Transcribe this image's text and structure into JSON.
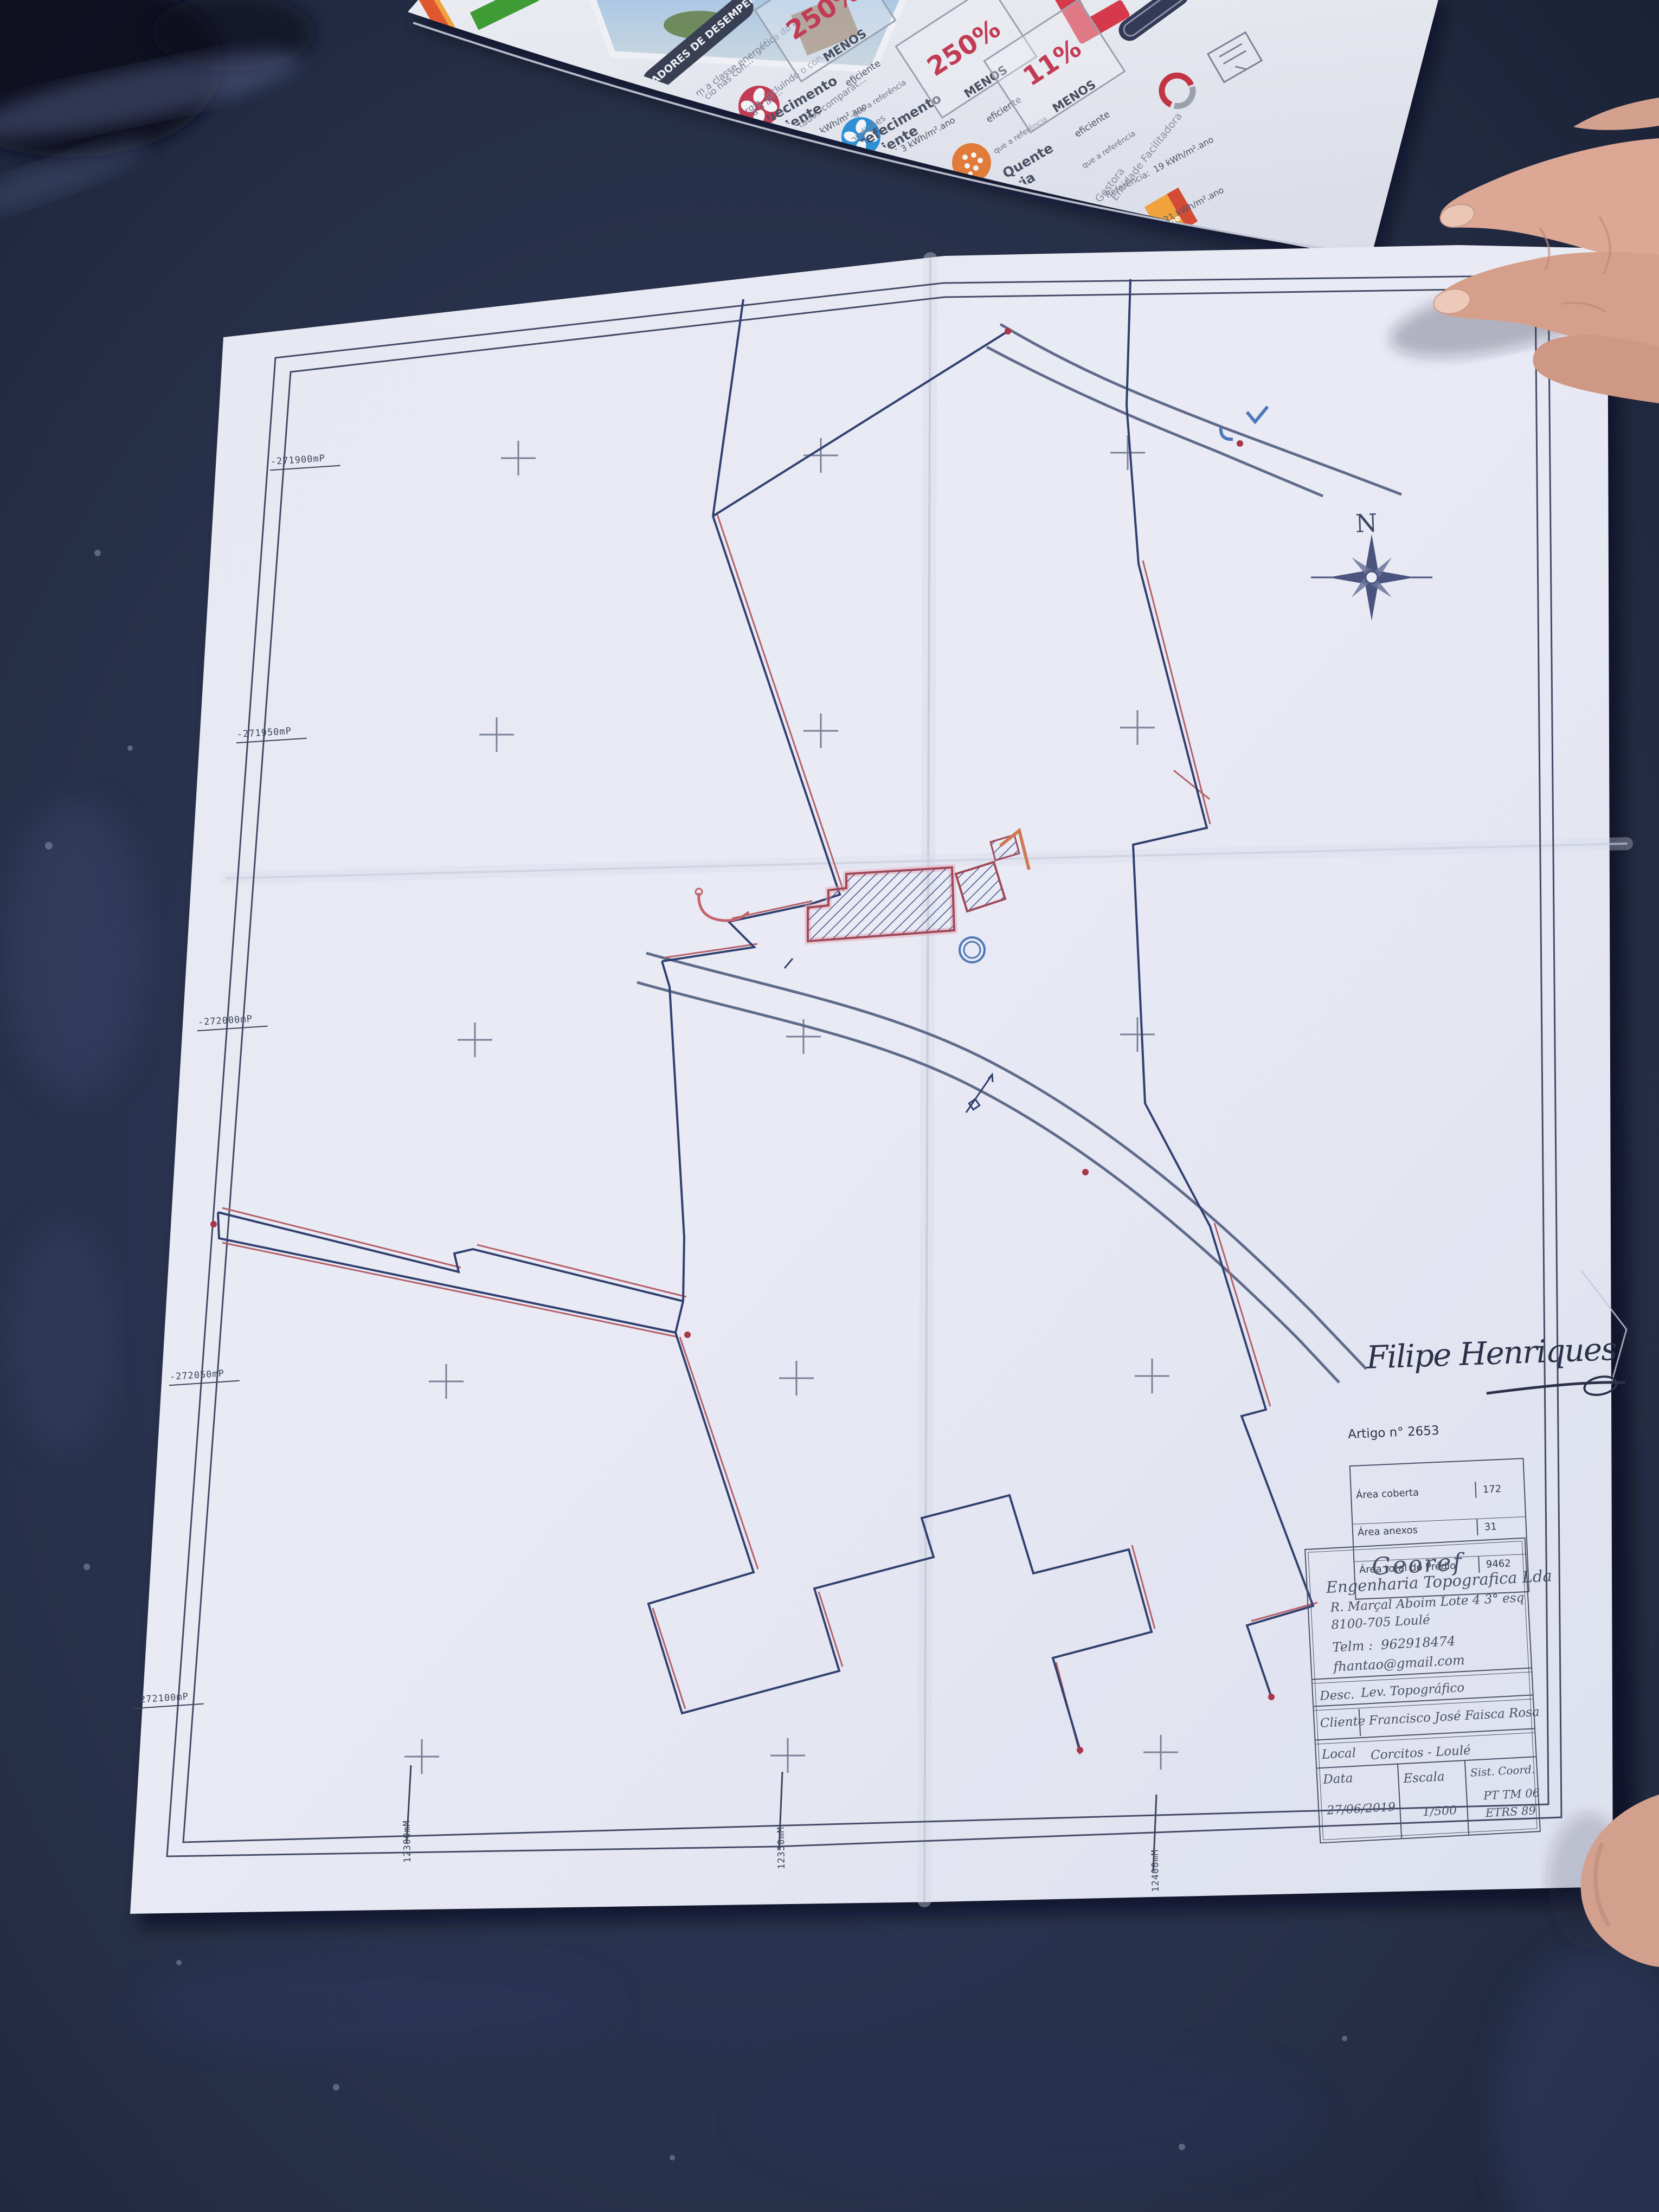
{
  "brochure": {
    "header": "INDICADORES DE DESEMPENHO",
    "intro_lines": [
      "Este certificado apresenta a cl...",
      "energético deste edifício nas con...",
      "ou requisitos aplicáveis para o an..."
    ],
    "body_lines": [
      "Determinam a classe energética do ed...",
      "utilização de energia, incluindo o con...",
      "renováveis. São apresentados comparat...",
      "de referência e calculados em condições"
    ],
    "sections": [
      {
        "title_1": "Aquecimento",
        "title_2": "Ambiente",
        "icon": "fan-red",
        "rows": [
          {
            "label": "Referência:",
            "value": "74 kWh/m².ano"
          },
          {
            "label": "Edifício:",
            "value": "291 kWh/m².ano"
          },
          {
            "label": "Renovável:",
            "value": "- %"
          }
        ]
      },
      {
        "title_1": "Arrefecimento",
        "title_2": "Ambiente",
        "icon": "fan-blue",
        "rows": [
          {
            "label": "Referência:",
            "value": "6,3 kWh/m².ano"
          },
          {
            "label": "Edifício:",
            "value": "27 kWh/m².ano"
          },
          {
            "label": "Renovável:",
            "value": "- %"
          }
        ]
      },
      {
        "title_1": "Água Quente",
        "title_2": "Sanitária",
        "icon": "drop-orange",
        "rows": [
          {
            "label": "Referência:",
            "value": "19 kWh/m².ano"
          },
          {
            "label": "Edifício:",
            "value": "21 kWh/m².ano"
          },
          {
            "label": "Renovável:",
            "value": "- %"
          }
        ]
      }
    ],
    "efficiency_boxes": [
      {
        "pct": "250%",
        "line1": "MENOS",
        "line2": "eficiente",
        "line3": "que a referência"
      },
      {
        "pct": "250%",
        "line1": "MENOS",
        "line2": "eficiente",
        "line3": "que a referência"
      },
      {
        "pct": "11%",
        "line1": "MENOS",
        "line2": "eficiente",
        "line3": "que a referência"
      }
    ],
    "logo_entidade_gestora": "Entidade Gestora",
    "logo_entidade_facilitadora": "Entidade Facilitadora",
    "logo_adene": "adene"
  },
  "plan": {
    "north_label": "N",
    "coords_left": [
      "-271900mP",
      "-271950mP",
      "-272000mP",
      "-272050mP",
      "-272100mP"
    ],
    "coords_bottom": [
      "12300mM",
      "12350mM",
      "12400mM"
    ],
    "signature": "Filipe Henriques",
    "artigo": {
      "title": "Artigo n° 2653",
      "rows": [
        {
          "label": "Área coberta",
          "value": "172"
        },
        {
          "label": "Área anexos",
          "value": "31"
        },
        {
          "label": "Área total do Prédio",
          "value": "9462"
        }
      ]
    },
    "title_block": {
      "company": "Georef",
      "subtitle": "Engenharia Topografica Lda",
      "address1": "R. Marçal Aboim Lote 4 3° esq",
      "address2": "8100-705 Loulé",
      "phone": "Telm :  962918474",
      "email": "fhantao@gmail.com",
      "desc_label": "Desc.",
      "desc_value": "Lev. Topográfico",
      "cliente_label": "Cliente",
      "cliente_value": "Francisco José Faisca Rosa",
      "local_label": "Local",
      "local_value": "Corcitos - Loulé",
      "data_label": "Data",
      "data_value": "27/06/2019",
      "escala_label": "Escala",
      "escala_value": "1/500",
      "coord_label": "Sist. Coord.",
      "coord_value_1": "PT TM 06",
      "coord_value_2": "ETRS 89"
    }
  }
}
